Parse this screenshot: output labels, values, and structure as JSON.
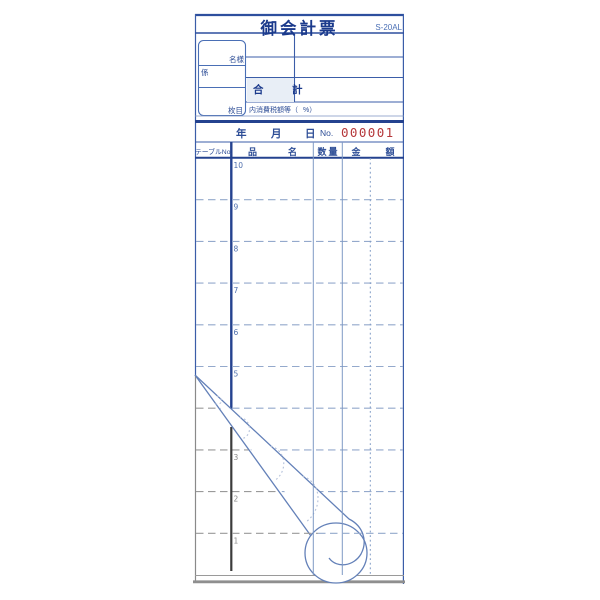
{
  "form": {
    "title": "御会計票",
    "model_number": "S-20AL",
    "customer_box": {
      "guests_label": "名様",
      "staff_label": "係",
      "pages_label": "枚目"
    },
    "total_label": "合　計",
    "tax_note_prefix": "内消費税額等（",
    "tax_note_suffix": "%）",
    "date_row": {
      "year_label": "年",
      "month_label": "月",
      "day_label": "日",
      "no_label": "No.",
      "serial": "000001"
    },
    "table": {
      "headers": {
        "table_no": "テーブルNo.",
        "item": "品　名",
        "qty": "数量",
        "amount": "金　額"
      },
      "row_numbers": [
        "10",
        "9",
        "8",
        "7",
        "6",
        "5",
        "4",
        "3",
        "2",
        "1"
      ],
      "row_4_note": "occluded by page curl"
    },
    "colors": {
      "accent_navy": "#24428f",
      "label_blue": "#2d4d96",
      "grid_light_blue": "#94a9cc",
      "serial_red": "#b5373a",
      "total_cell_bg": "#e8eef6",
      "undersheet_gray": "#8f8f8f",
      "undersheet_black": "#3c3c3c"
    }
  }
}
